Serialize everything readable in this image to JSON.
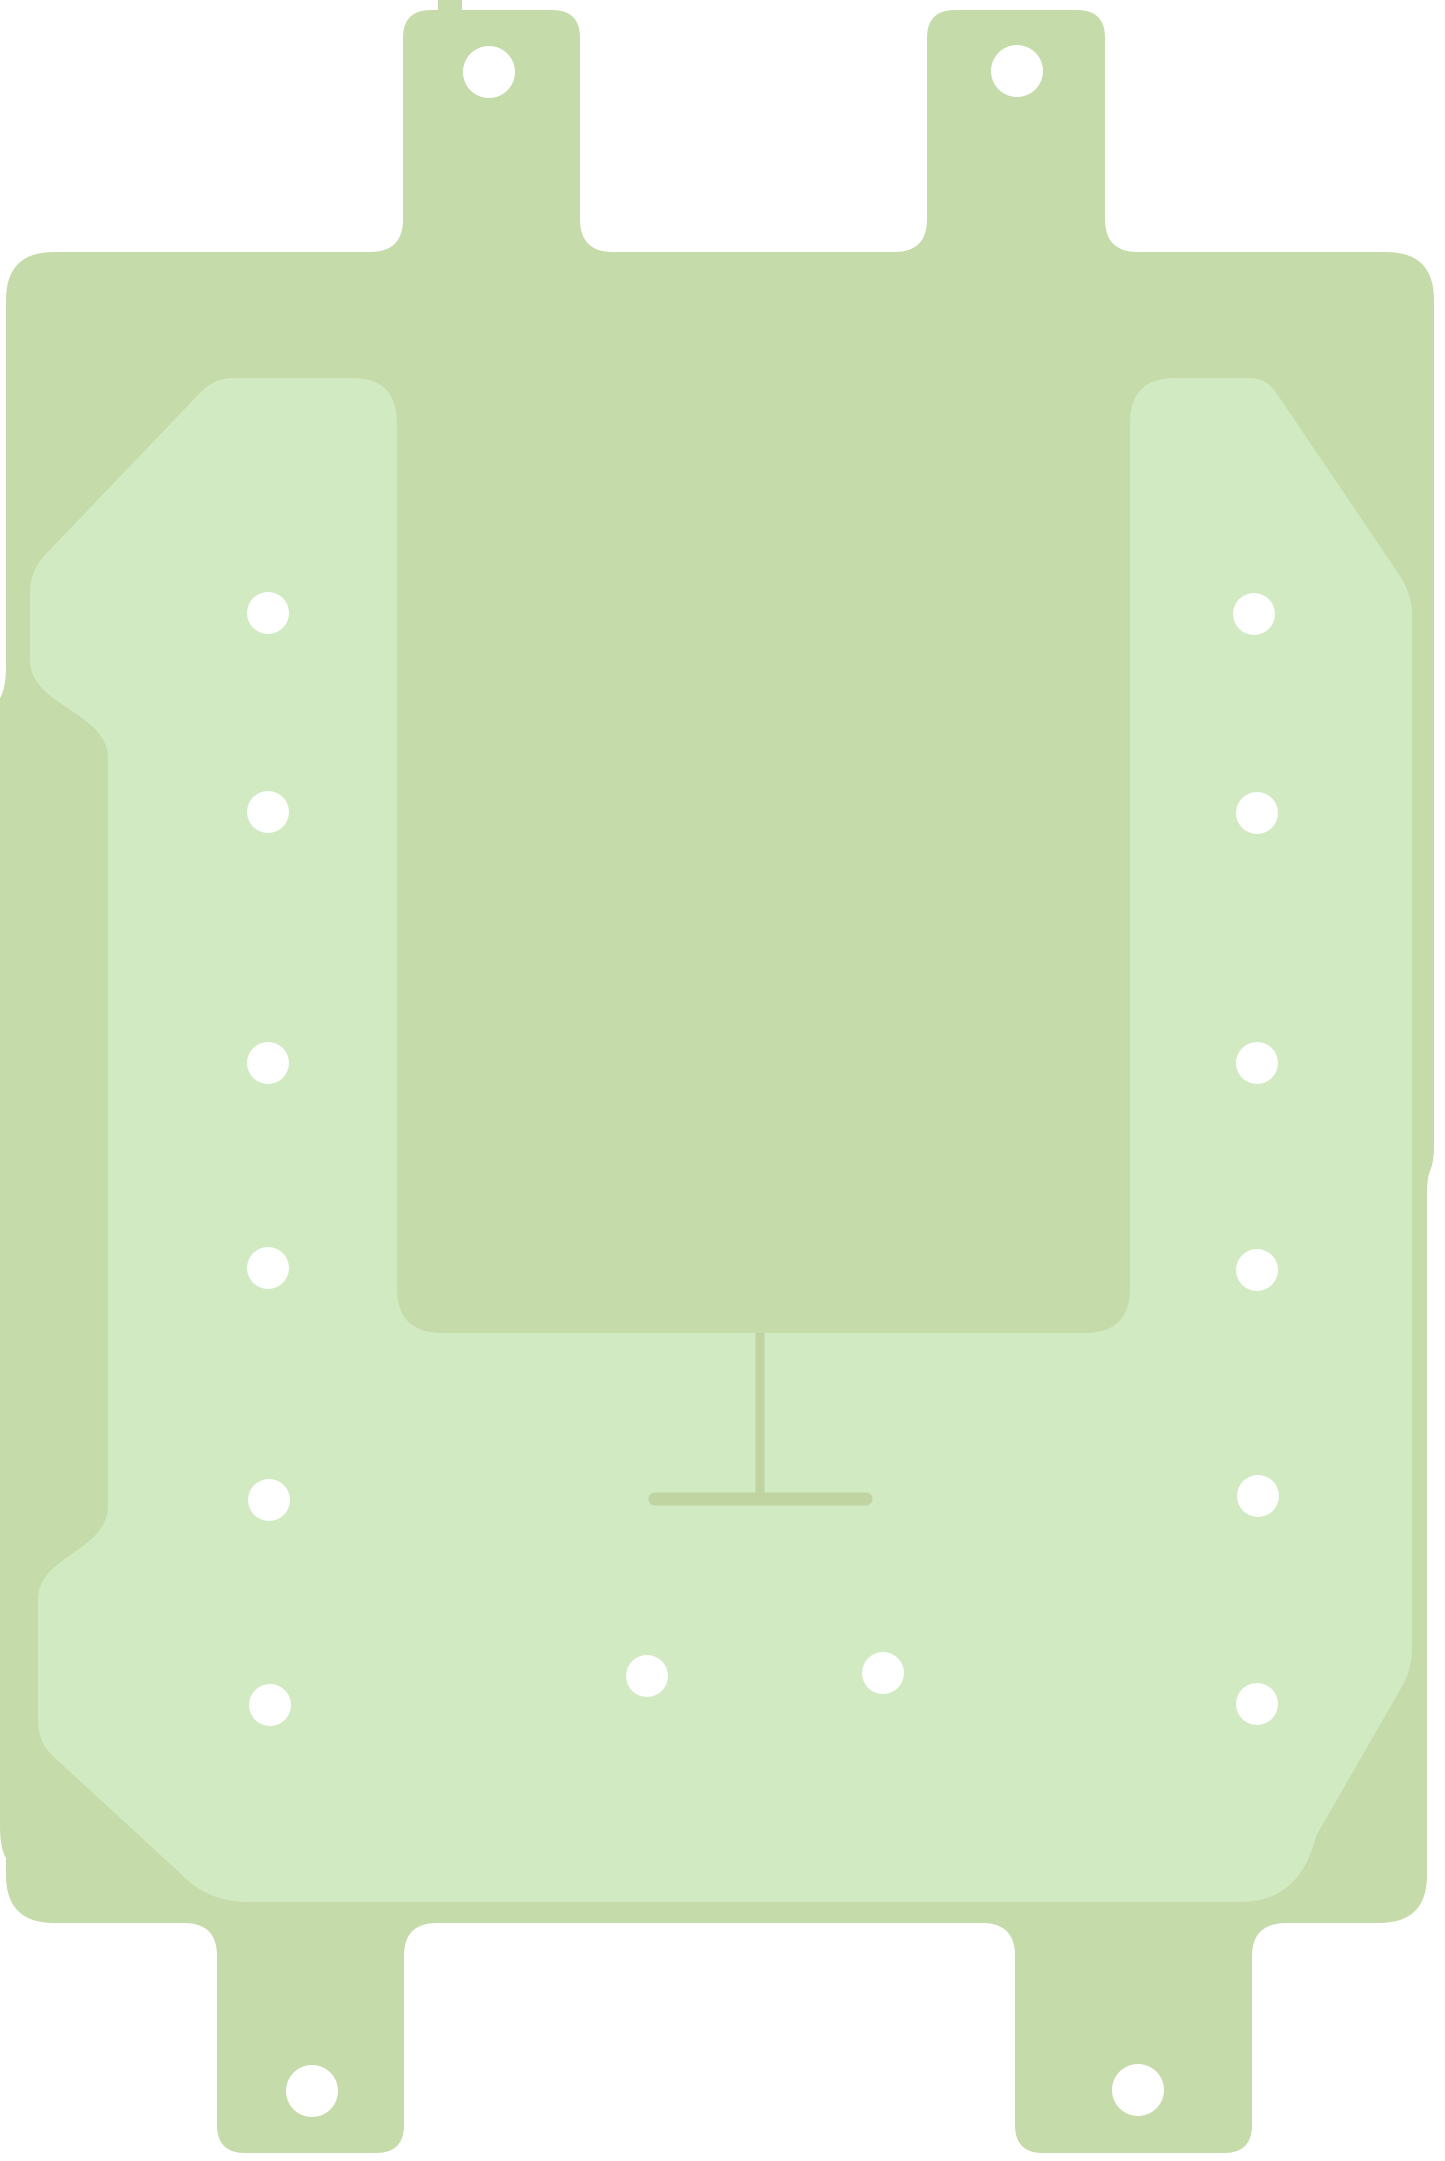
{
  "image": {
    "description": "Die-cut pale green adhesive gasket sheet (battery adhesive style) on a white background: rectangular base with two top tabs and two bottom tabs, each tab with a round punch hole; a lighter green U-shaped liner panel with rows of small punched holes along the left and right columns and along the bottom band; a rectangular notch in the top center exposing the base color; thin score lines forming an inverted T below the notch",
    "canvas": {
      "width": 1445,
      "height": 2161
    },
    "colors": {
      "background": "#ffffff",
      "base": "#c6dbaa",
      "panel": "#d2eac2",
      "cut_line": "#bfd4a0",
      "hole": "#ffffff"
    },
    "shapes": {
      "base_path": "M 6 300 Q 6 252 54 252 L 370 252 Q 403 252 403 219 L 403 38 Q 403 10 431 10 L 438 10 L 438 0 L 462 0 L 462 10 L 552 10 Q 580 10 580 38 L 580 219 Q 580 252 613 252 L 894 252 Q 927 252 927 219 L 927 38 Q 927 10 955 10 L 1077 10 Q 1105 10 1105 38 L 1105 219 Q 1105 252 1138 252 L 1386 252 Q 1434 252 1434 300 L 1434 1146 Q 1434 1162 1430 1171 Q 1427 1179 1427 1192 L 1427 1875 Q 1427 1923 1379 1923 L 1287 1923 Q 1252 1923 1252 1956 L 1252 2125 Q 1252 2153 1224 2153 L 1043 2153 Q 1015 2153 1015 2125 L 1015 1956 Q 1015 1923 982 1923 L 437 1923 Q 404 1923 404 1956 L 404 2125 Q 404 2153 376 2153 L 245 2153 Q 217 2153 217 2125 L 217 1956 Q 217 1923 184 1923 L 54 1923 Q 6 1923 6 1875 L 6 1858 Q 0 1848 0 1826 L 0 698 Q 6 688 6 666 Z",
      "panel_path": "M 233 378 L 352 378 Q 397 378 397 423 L 397 1288 Q 397 1333 442 1333 L 1085 1333 Q 1130 1333 1130 1288 L 1130 423 Q 1130 378 1175 378 L 1249 378 Q 1266 378 1275 391 L 1396 570 Q 1412 592 1412 614 L 1412 1648 Q 1412 1671 1400 1690 L 1316 1836 Q 1300 1902 1240 1902 L 248 1902 Q 207 1902 180 1873 L 55 1758 Q 38 1743 38 1721 L 38 1600 C 38 1555 108 1552 108 1505 L 108 758 C 108 712 30 706 30 660 L 30 592 Q 30 571 45 555 L 196 397 Q 212 378 233 378 Z",
      "score_lines": {
        "vertical": {
          "x": 760,
          "y1": 1333,
          "y2": 1495,
          "width": 9
        },
        "horizontal": {
          "x1": 655,
          "x2": 866,
          "y": 1499,
          "width": 13
        }
      },
      "tab_holes": {
        "radius": 26,
        "centers": [
          {
            "x": 489,
            "y": 72
          },
          {
            "x": 1017,
            "y": 71
          },
          {
            "x": 312,
            "y": 2091
          },
          {
            "x": 1138,
            "y": 2090
          }
        ]
      },
      "panel_holes": {
        "radius": 21,
        "centers": [
          {
            "x": 268,
            "y": 613
          },
          {
            "x": 268,
            "y": 812
          },
          {
            "x": 268,
            "y": 1063
          },
          {
            "x": 268,
            "y": 1268
          },
          {
            "x": 269,
            "y": 1500
          },
          {
            "x": 270,
            "y": 1705
          },
          {
            "x": 1254,
            "y": 614
          },
          {
            "x": 1257,
            "y": 813
          },
          {
            "x": 1257,
            "y": 1063
          },
          {
            "x": 1257,
            "y": 1270
          },
          {
            "x": 1258,
            "y": 1496
          },
          {
            "x": 1257,
            "y": 1704
          },
          {
            "x": 647,
            "y": 1676
          },
          {
            "x": 883,
            "y": 1673
          }
        ]
      }
    }
  }
}
